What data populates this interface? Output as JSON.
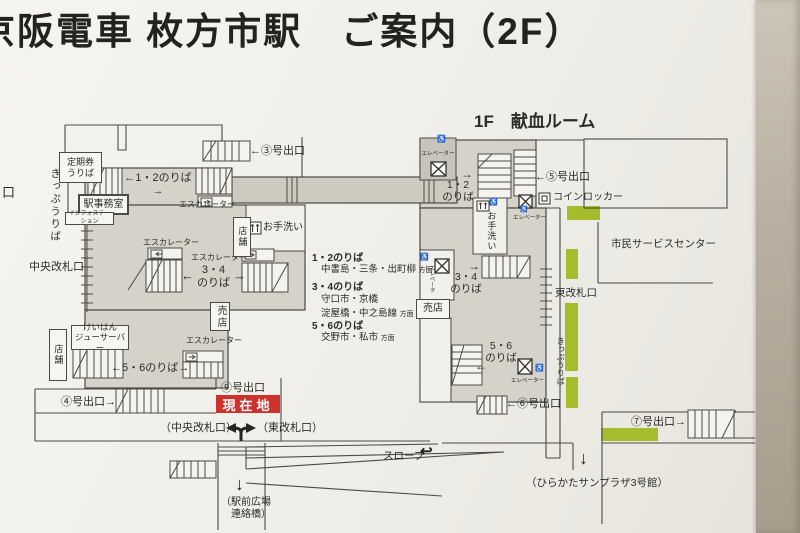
{
  "title": "京阪電車 枚方市駅　ご案内（2F）",
  "current_location_label": "現在地",
  "exits": {
    "exit3": "←③号出口",
    "exit4": "④号出口→",
    "exit5": "←⑤号出口",
    "exit6": "←⑥号出口",
    "exit7": "⑦号出口→",
    "exit9": "⑨号出口",
    "left_edge_cutoff": "口"
  },
  "platforms": {
    "west_12": "←1・2のりば→",
    "west_34": "3・4\nのりば",
    "west_56": "←5・6のりば→",
    "east_12": "1・2\nのりば",
    "east_34": "3・4\nのりば",
    "east_56": "5・6\nのりば"
  },
  "icons": {
    "arrow_left": "←",
    "arrow_right": "→",
    "arrow_down": "↓",
    "slope_turn_arrow": "↩",
    "wheelchair": "♿"
  },
  "facilities": {
    "blood_donation_room": "1F　献血ルーム",
    "commuter_pass_office": "定期券\nうりば",
    "ticket_office_west": "きっぷうりば",
    "station_office": "駅事務室",
    "info_station": "インフォステーション",
    "central_gate": "中央改札口",
    "shop_small_center": "店舗",
    "toilet_west": "お手洗い",
    "escalator": "エスカレーター",
    "kiosk_west": "売店",
    "keihan_juicer_bar": "けいはん\nジューサーバー",
    "shop_small_left": "店舗",
    "elevator": "エレベーター",
    "coin_locker": "コインロッカー",
    "civic_service_center": "市民サービスセンター",
    "east_gate": "東改札口",
    "ticket_office_east": "きっぷうりば",
    "toilet_east": "お手洗い",
    "kiosk_east": "売店",
    "slope": "スロープ"
  },
  "route_info": [
    {
      "head": "1・2のりば",
      "dest": "中書島・三条・出町柳",
      "suffix": "方面"
    },
    {
      "head": "3・4のりば",
      "dest": "守口市・京橋\n淀屋橋・中之島線",
      "suffix": "方面"
    },
    {
      "head": "5・6のりば",
      "dest": "交野市・私市",
      "suffix": "方面"
    }
  ],
  "bottom_labels": {
    "central_gate_paren": "（中央改札口）",
    "east_gate_paren": "（東改札口）",
    "plaza_bridge": "（駅前広場\n　連絡橋）",
    "sunplaza": "（ひらかたサンプラザ3号館）"
  },
  "colors": {
    "paid_area": "#d5d2c9",
    "corridor": "#cdcabf",
    "ticket_machine_green": "#a5bd2c",
    "current_location_bg": "#ce322d",
    "line": "#4d4a45"
  }
}
